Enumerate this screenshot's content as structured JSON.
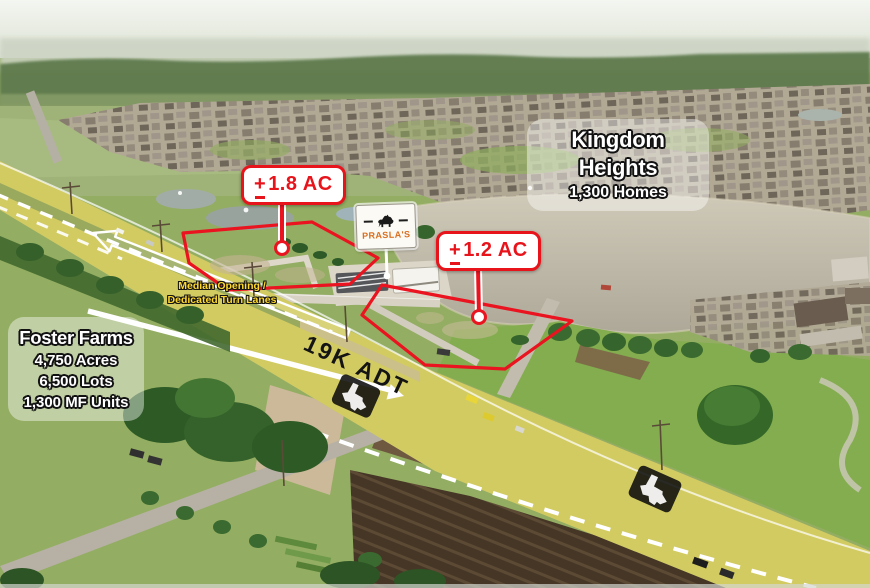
{
  "flyer": {
    "kingdom": {
      "title": "Kingdom Heights",
      "subtitle": "1,300 Homes"
    },
    "foster": {
      "title": "Foster Farms",
      "stats": [
        "4,750 Acres",
        "6,500 Lots",
        "1,300 MF Units"
      ]
    },
    "parcel_large": {
      "sign": "+",
      "area": "1.8 AC"
    },
    "parcel_small": {
      "sign": "+",
      "area": "1.2 AC"
    },
    "median": {
      "line1": "Median Opening /",
      "line2": "Dedicated Turn Lanes"
    },
    "traffic": {
      "adt": "19K ADT"
    },
    "prasla": {
      "brand": "PRASLA'S"
    }
  },
  "icons": {
    "prasla_mascot": "bear-silhouette-icon",
    "road_watermark": "texas-state-icon",
    "westbound": "westbound-traffic-arrow",
    "eastbound": "eastbound-traffic-arrow"
  },
  "colors": {
    "parcel_red": "#e8141c",
    "road_highlight_yellow": "#f2ea35",
    "median_note_yellow": "#ffd92e",
    "prasla_orange": "#d96e1e",
    "lake_gray": "#c2bcab"
  }
}
